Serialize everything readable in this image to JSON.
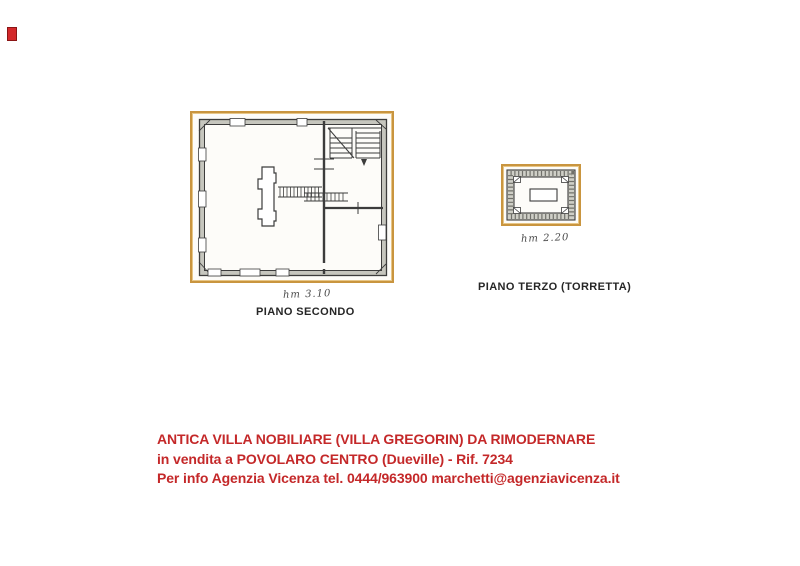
{
  "page": {
    "background": "#ffffff"
  },
  "artifact_square": {
    "fill_color": "#d3282a",
    "border_color": "#8a1515"
  },
  "floor_plans": {
    "frame_color": "#c9953f",
    "wall_color": "#3c3c3c",
    "wall_fill": "#c6c6be",
    "piano_secondo": {
      "caption": "PIANO SECONDO",
      "height_label": "hm 3.10"
    },
    "piano_terzo": {
      "caption": "PIANO TERZO (TORRETTA)",
      "height_label": "hm 2.20"
    }
  },
  "listing": {
    "text_color": "#c42829",
    "title": "ANTICA VILLA NOBILIARE (VILLA GREGORIN) DA RIMODERNARE",
    "subtitle": "in vendita a POVOLARO CENTRO (Dueville) - Rif. 7234",
    "contact": "Per info Agenzia Vicenza tel. 0444/963900 marchetti@agenziavicenza.it"
  }
}
